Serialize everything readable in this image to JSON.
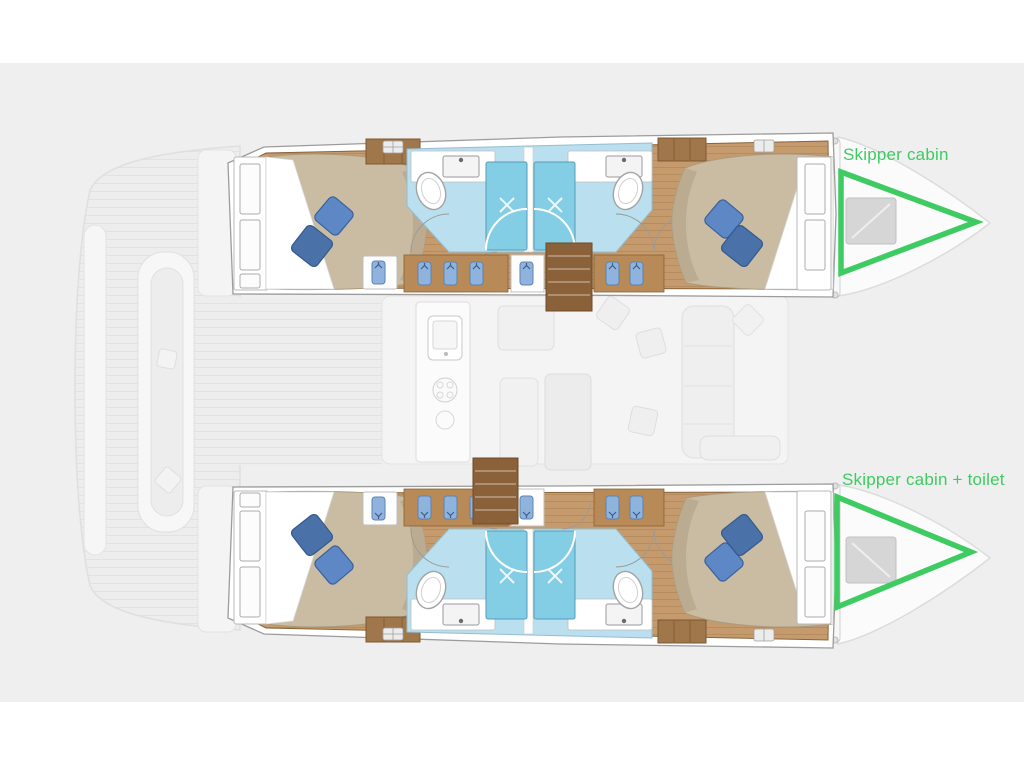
{
  "canvas": {
    "background_color": "#ffffff",
    "plan_area_color": "#efefef"
  },
  "annotations": {
    "accent_color": "#3ecb62",
    "labels": [
      {
        "id": "skipper-cabin",
        "text": "Skipper cabin"
      },
      {
        "id": "skipper-cabin-toilet",
        "text": "Skipper cabin + toilet"
      }
    ]
  },
  "palette": {
    "wood_floor": "#c59b6d",
    "wood_furniture": "#a0774b",
    "wood_stairs": "#8a6138",
    "bathroom_floor": "#badfee",
    "shower": "#83cde5",
    "duvet": "#c9bca3",
    "pillow_light": "#5e87c6",
    "pillow_dark": "#4a71a8"
  },
  "icons": {
    "bed": "bed-icon",
    "pillow": "pillow-icon",
    "shower": "shower-icon",
    "toilet": "toilet-icon",
    "sink": "sink-icon",
    "wardrobe": "wardrobe-icon",
    "hanging_clothes": "clothes-icon",
    "stairs": "stairs-icon",
    "deck_hatch": "hatch-icon",
    "cockpit_table": "cockpit-table",
    "dining_table": "dining-table-icon",
    "stove": "stove-icon",
    "galley_sink": "galley-sink-icon"
  }
}
